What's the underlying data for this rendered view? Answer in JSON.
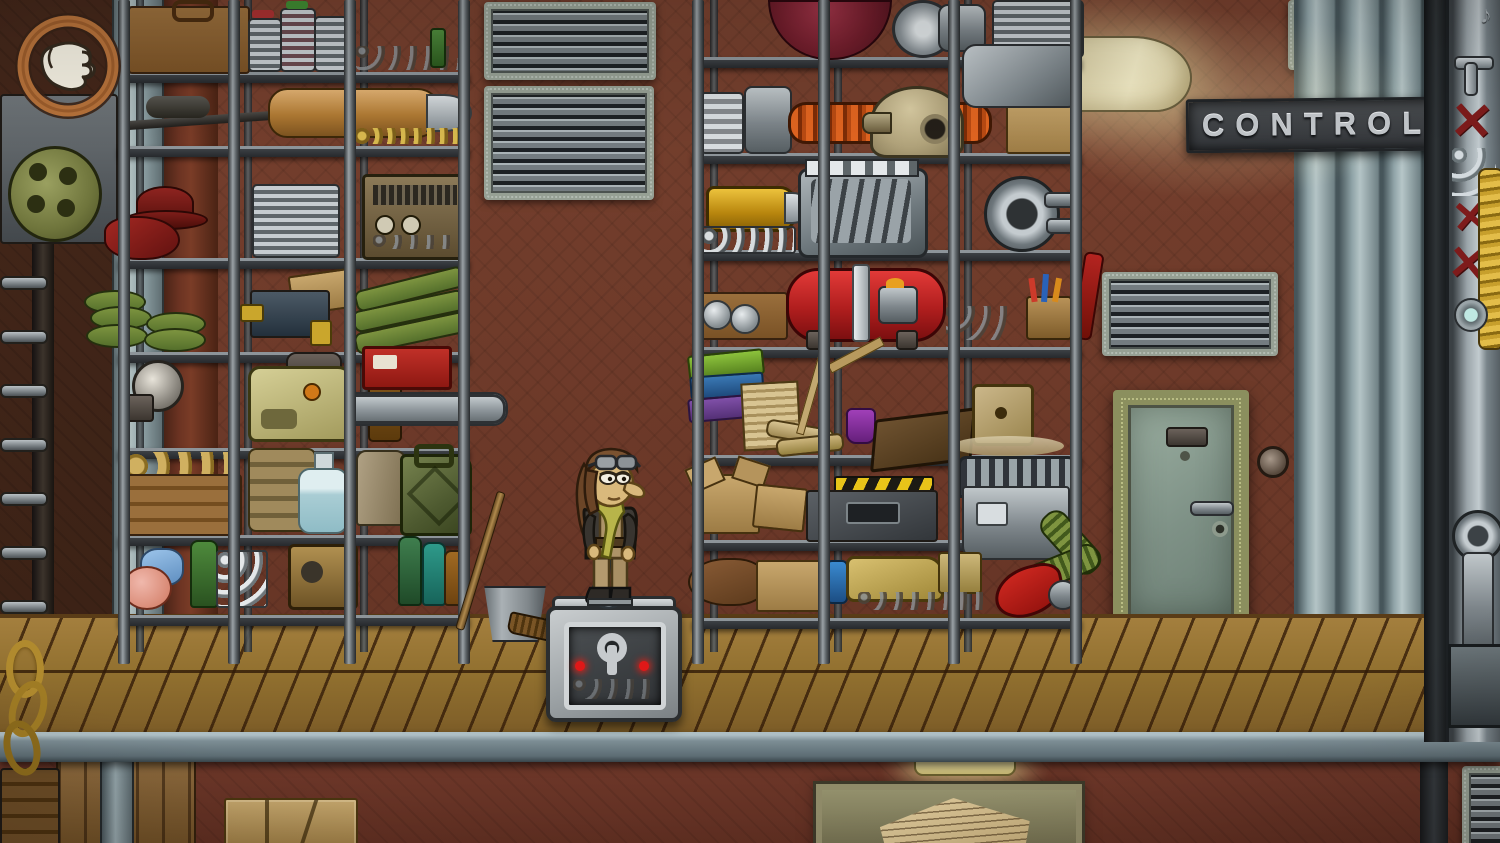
{
  "scene": {
    "title": "Steampunk storage room",
    "sign": {
      "text": "CONTROL"
    },
    "icons": {
      "cursor": "hand-cursor-emblem",
      "music_note_glyph": "♪",
      "x_mark_glyph": "✕",
      "x_mark_count": 3
    },
    "objects": [
      "hand-cursor-emblem",
      "ladder",
      "wall-pipe",
      "storage-rack-left",
      "storage-rack-middle",
      "suitcase",
      "paint-cans",
      "sniper-rifle",
      "brass-torpedo",
      "ammo-belt",
      "red-fedora",
      "red-scarf",
      "engine-cylinders",
      "radio",
      "land-mines",
      "power-drill",
      "artillery-shells",
      "lantern",
      "chainsaw",
      "first-aid-kit",
      "egg-crate",
      "sandbags",
      "carboy",
      "grater",
      "jerry-can",
      "flasks",
      "vial-rack",
      "generator",
      "bottles",
      "red-balloon",
      "turbine",
      "tin-cans",
      "orange-coil-pipe",
      "diving-helmet",
      "cardboard-box",
      "yellow-shell",
      "typewriter",
      "slider-engine",
      "pump-wheel",
      "binoculars-box",
      "red-pressure-tank",
      "tool-set",
      "pencil-cup",
      "books",
      "paper-stack",
      "scrolls",
      "drafting-tools",
      "ink-bottle",
      "old-book",
      "wooden-die",
      "open-boxes",
      "hazard-device",
      "vacuum-machine",
      "green-hose",
      "sack",
      "blue-vial",
      "gold-drill",
      "mug",
      "red-horn",
      "broom",
      "bucket",
      "mechanic-character",
      "blue-wrench",
      "metal-puzzle-box",
      "ventilation-grilles",
      "control-sign",
      "wall-lamp",
      "metal-door",
      "doorbell-button",
      "crossed-out-machine",
      "yellow-coil",
      "piston-machine",
      "notice-board",
      "parcel",
      "wooden-walkway",
      "steel-beam",
      "chain-links"
    ],
    "colors": {
      "wall": "#6e3a2a",
      "floor": "#96713e",
      "beam": "#7c8d94",
      "door": "#8ba092",
      "door_frame": "#8b8f5e",
      "sign_plaque": "#3f4245",
      "sign_letters": "#c3c7cb",
      "lamp": "#f2ebc6",
      "cursor_ring": "#b5713a",
      "tank_red": "#c4252b",
      "x_mark": "#7e1b1b",
      "coil_yellow": "#d9af35",
      "helmet": "#b5a886",
      "shell_yellow": "#d8a520",
      "jerry_green": "#5f6b46"
    }
  }
}
